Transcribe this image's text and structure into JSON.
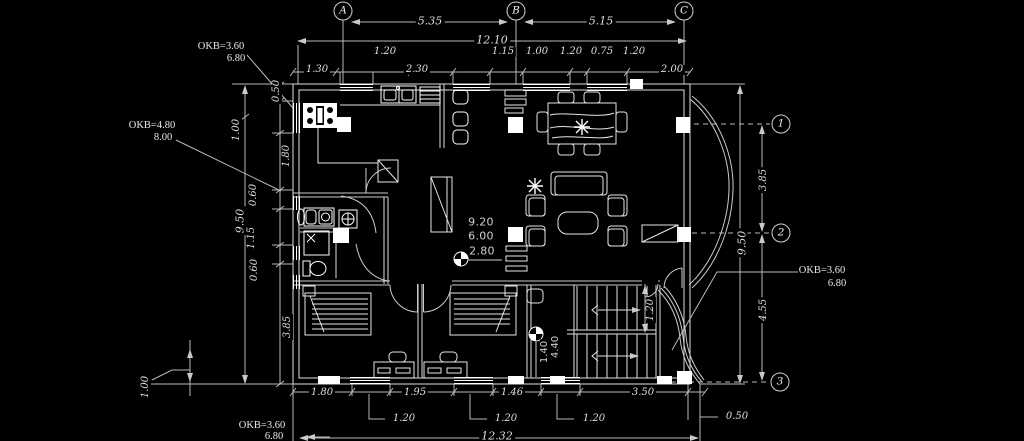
{
  "meta": {
    "drawing_type": "architectural floor plan (CAD, ground floor)",
    "background_color": "#000000",
    "line_color": "#d6d6d6",
    "highlight_color": "#ffffff"
  },
  "grid": {
    "columns": [
      "A",
      "B",
      "C"
    ],
    "rows": [
      "1",
      "2",
      "3"
    ]
  },
  "dims_top": {
    "span_ab": "5.35",
    "span_bc": "5.15",
    "total": "12.10",
    "callouts": [
      "1.20",
      "1.15",
      "1.00",
      "1.20",
      "0.75",
      "1.20"
    ],
    "chain": [
      "1.30",
      "2.30",
      "2.00"
    ]
  },
  "dims_left": {
    "chain": [
      "0.50",
      "1.00",
      "1.80",
      "0.60",
      "1.15",
      "0.60",
      "3.85"
    ],
    "total": "9.50",
    "ground_offset": "1.00"
  },
  "dims_right": {
    "span_1_2": "3.85",
    "span_2_3": "4.55",
    "total": "9.50",
    "stair_width": "1.20"
  },
  "dims_bottom": {
    "chain": [
      "1.80",
      "1.95",
      "1.46",
      "3.50"
    ],
    "window_callouts": [
      "1.20",
      "1.20",
      "1.20"
    ],
    "edge_offset": "0.50",
    "total": "12.32"
  },
  "levels": {
    "top_left": {
      "line1": "OKB=3.60",
      "line2": "6.80"
    },
    "mid_left": {
      "line1": "OKB=4.80",
      "line2": "8.00"
    },
    "right": {
      "line1": "OKB=3.60",
      "line2": "6.80"
    },
    "bottom": {
      "line1": "OKB=3.60",
      "line2": "6.80"
    }
  },
  "floor_levels": [
    "9.20",
    "6.00",
    "2.80"
  ],
  "stair_levels": [
    "4.40",
    "1.40"
  ]
}
